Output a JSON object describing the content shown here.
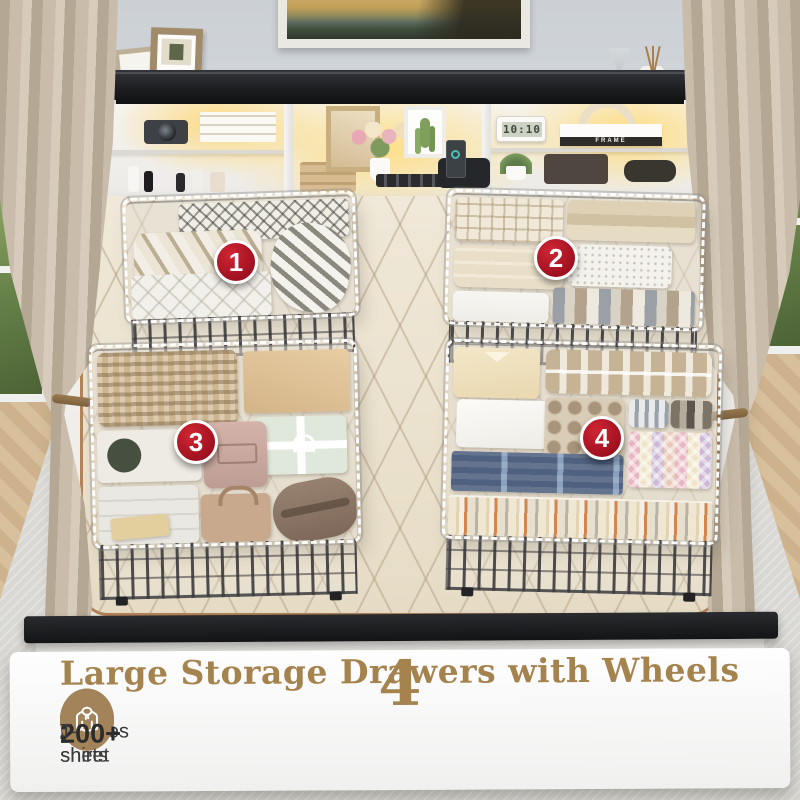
{
  "scene": {
    "headboard": {
      "clock_time": "10:10",
      "book_spine": "FRAME"
    },
    "drawer_badges": [
      {
        "number": "1"
      },
      {
        "number": "2"
      },
      {
        "number": "3"
      },
      {
        "number": "4"
      }
    ]
  },
  "banner": {
    "headline_number": "4",
    "headline_text": "Large Storage Drawers with Wheels",
    "features": [
      {
        "icon": "bed-sheets-icon",
        "count": "40+",
        "label": "bed sheet"
      },
      {
        "icon": "pants-icon",
        "count": "200+",
        "label": "pants"
      },
      {
        "icon": "scarf-icon",
        "count": "100+",
        "label": "scarves"
      },
      {
        "icon": "hoodie-icon",
        "count": "200+",
        "label": "T-shirts"
      }
    ]
  },
  "colors": {
    "accent_tan": "#a3835a",
    "title_tan": "#a5834f",
    "badge_red": "#ab1220",
    "led_glow": "#ffd87a",
    "mattress_cream": "#ece3d0",
    "frame_black": "#1b1c1e"
  }
}
